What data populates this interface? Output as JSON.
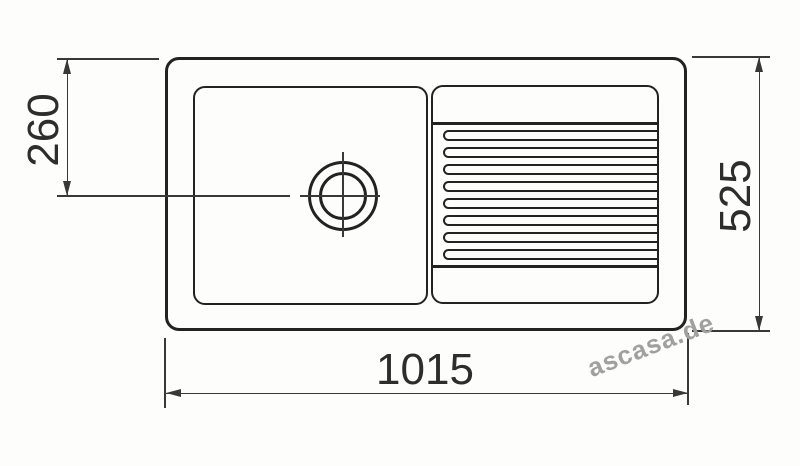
{
  "drawing": {
    "type": "sink-plan-technical-drawing",
    "dimensions": {
      "overall_width": {
        "label": "1015"
      },
      "overall_depth": {
        "label": "525"
      },
      "drain_center_offset": {
        "label": "260"
      }
    },
    "drainboard": {
      "ridge_count": 8
    },
    "watermark": {
      "text": "ascasa.de"
    },
    "colors": {
      "ink": "#222222",
      "dimension_line": "#383838",
      "watermark": "#a0a0a0",
      "paper": "#fdfdfc"
    }
  }
}
